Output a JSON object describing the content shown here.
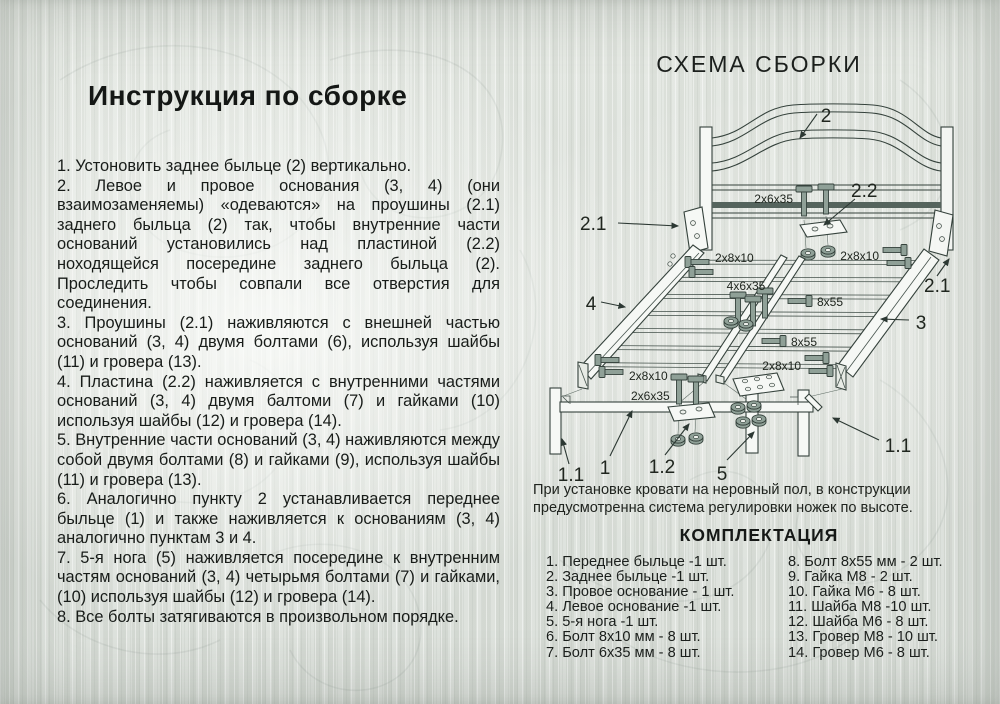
{
  "colors": {
    "paper": "#dde1db",
    "ink": "#181c19",
    "line": "#35423c",
    "hardware": "#8fa097",
    "rail_stripe": "#55645d"
  },
  "instructions": {
    "title": "Инструкция по сборке",
    "steps": [
      "1.  Устоновить заднее быльце (2) вертикально.",
      "2. Левое и провое основания (3, 4) (они взаимозаменяемы) «одеваются» на проушины (2.1) заднего быльца (2) так, чтобы внутренние части оснований установились над пластиной (2.2) ноходящейся посередине заднего быльца (2). Проследить чтобы совпали все отверстия для соединения.",
      "3. Проушины (2.1) наживляются с внешней частью оснований (3, 4) двумя болтами (6), используя шайбы (11) и гровера (13).",
      "4. Пластина (2.2) наживляется с внутренними частями оснований (3, 4) двумя балтоми (7) и гайками (10) используя шайбы (12) и гровера (14).",
      "5. Внутренние части оснований (3, 4) наживляются между собой двумя болтами (8) и гайками (9), используя шайбы (11) и гровера (13).",
      "6. Аналогично пункту 2 устанавливается переднее быльце (1) и также наживляется к основаниям (3, 4) аналогично пунктам 3 и 4.",
      "7. 5-я нога (5) наживляется посередине к внутренним частям оснований (3, 4) четырьмя болтами (7) и гайками, (10) используя шайбы (12) и гровера (14).",
      "8. Все болты затягиваются в произвольном порядке."
    ]
  },
  "diagram": {
    "title": "СХЕМА СБОРКИ",
    "callouts": {
      "c1": "1",
      "c11": "1.1",
      "c12": "1.2",
      "c2": "2",
      "c21": "2.1",
      "c22": "2.2",
      "c3": "3",
      "c4": "4",
      "c5": "5"
    },
    "hw": {
      "b2x6x35": "2x6x35",
      "b2x8x10": "2x8x10",
      "b4x6x35": "4x6x35",
      "b8x55": "8x55"
    }
  },
  "note": {
    "text": "При установке кровати на неровный пол, в конструкции предусмотренна система регулировки ножек по высоте."
  },
  "parts": {
    "title": "КОМПЛЕКТАЦИЯ",
    "left": [
      "1. Переднее быльце -1 шт.",
      "2. Заднее быльце -1 шт.",
      "3. Провое основание - 1 шт.",
      "4. Левое основание -1 шт.",
      "5. 5-я нога -1 шт.",
      "6. Болт 8х10 мм - 8 шт.",
      "7. Болт 6х35 мм - 8 шт."
    ],
    "right": [
      "8. Болт 8х55 мм - 2 шт.",
      "9. Гайка М8 - 2 шт.",
      "10. Гайка М6 - 8 шт.",
      "11. Шайба М8 -10 шт.",
      "12. Шайба М6 - 8 шт.",
      "13. Гровер М8 - 10 шт.",
      "14. Гровер М6 - 8 шт."
    ]
  }
}
